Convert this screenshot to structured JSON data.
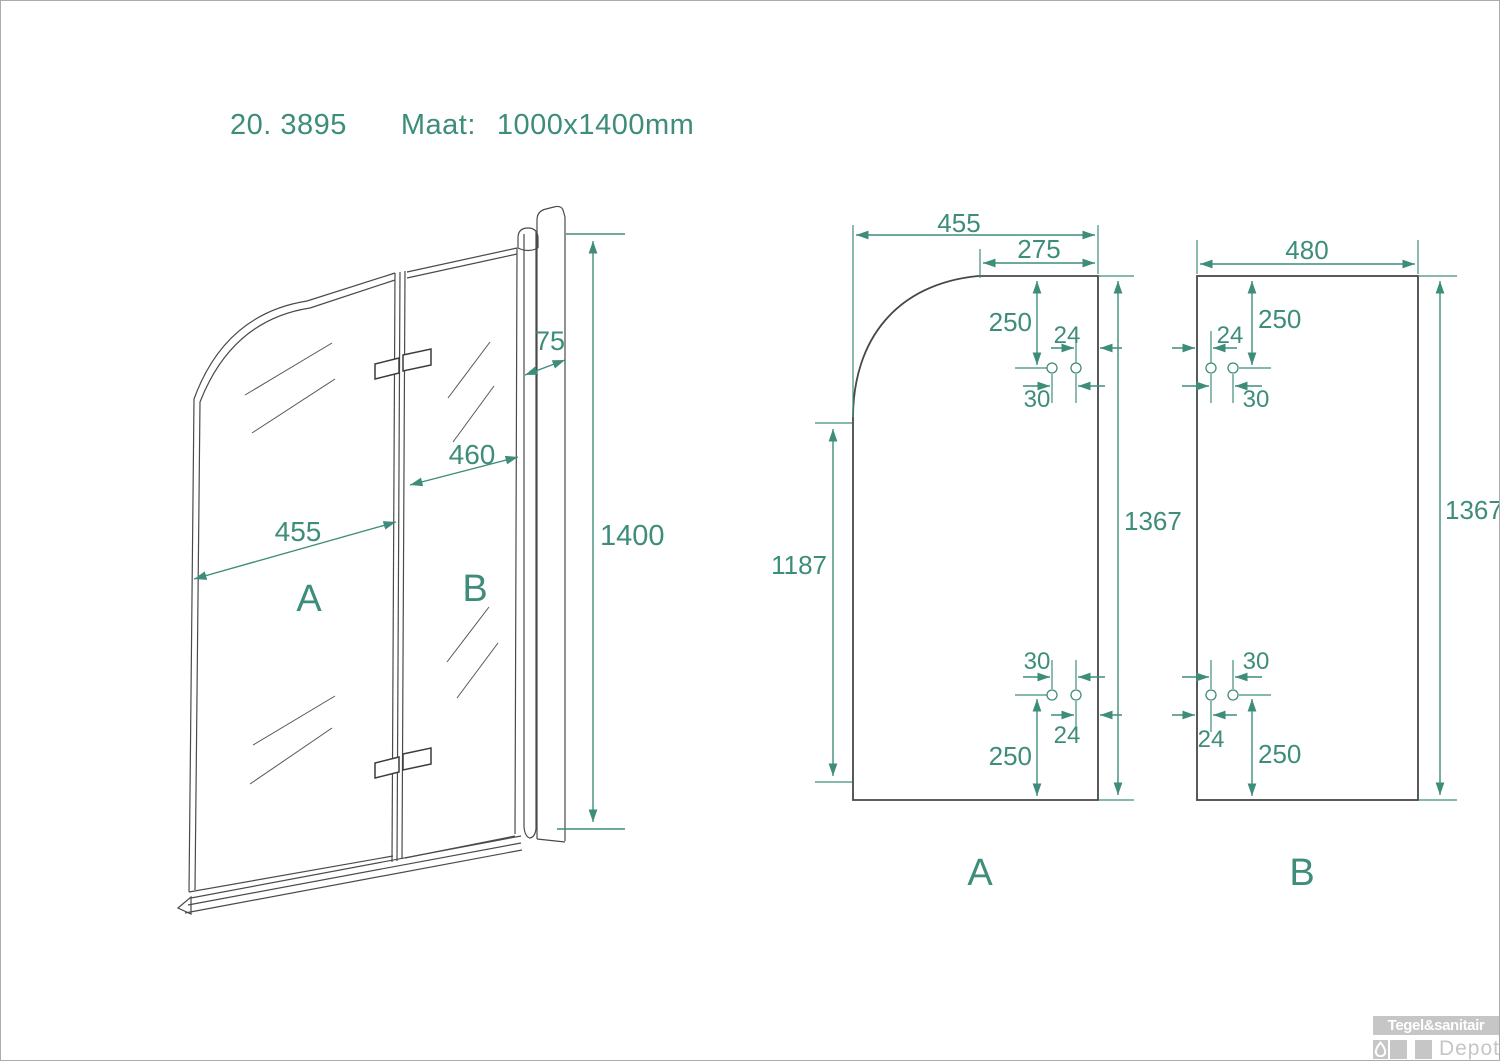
{
  "title": {
    "model_number": "20. 3895",
    "size_label": "Maat:",
    "size_value": "1000x1400mm"
  },
  "perspective_view": {
    "panel_a_label": "A",
    "panel_b_label": "B",
    "width_a": "455",
    "width_b": "460",
    "profile_depth": "75",
    "total_height": "1400"
  },
  "panel_a": {
    "label": "A",
    "width": "455",
    "top_flat_width": "275",
    "top_hole_offset": "250",
    "top_hole_edge_distance": "24",
    "top_hole_spacing": "30",
    "left_edge_height": "1187",
    "height": "1367",
    "bottom_hole_spacing": "30",
    "bottom_hole_edge_distance": "24",
    "bottom_hole_offset": "250"
  },
  "panel_b": {
    "label": "B",
    "width": "480",
    "top_hole_offset": "250",
    "top_hole_edge_distance": "24",
    "top_hole_spacing": "30",
    "height": "1367",
    "bottom_hole_spacing": "30",
    "bottom_hole_edge_distance": "24",
    "bottom_hole_offset": "250"
  },
  "logo": {
    "brand": "Tegel&sanitair",
    "sub_brand": "Depot"
  },
  "colors": {
    "dimension_green": "#3E8D7A",
    "line_dark": "#474747",
    "logo_gray": "#c6c6c6"
  }
}
